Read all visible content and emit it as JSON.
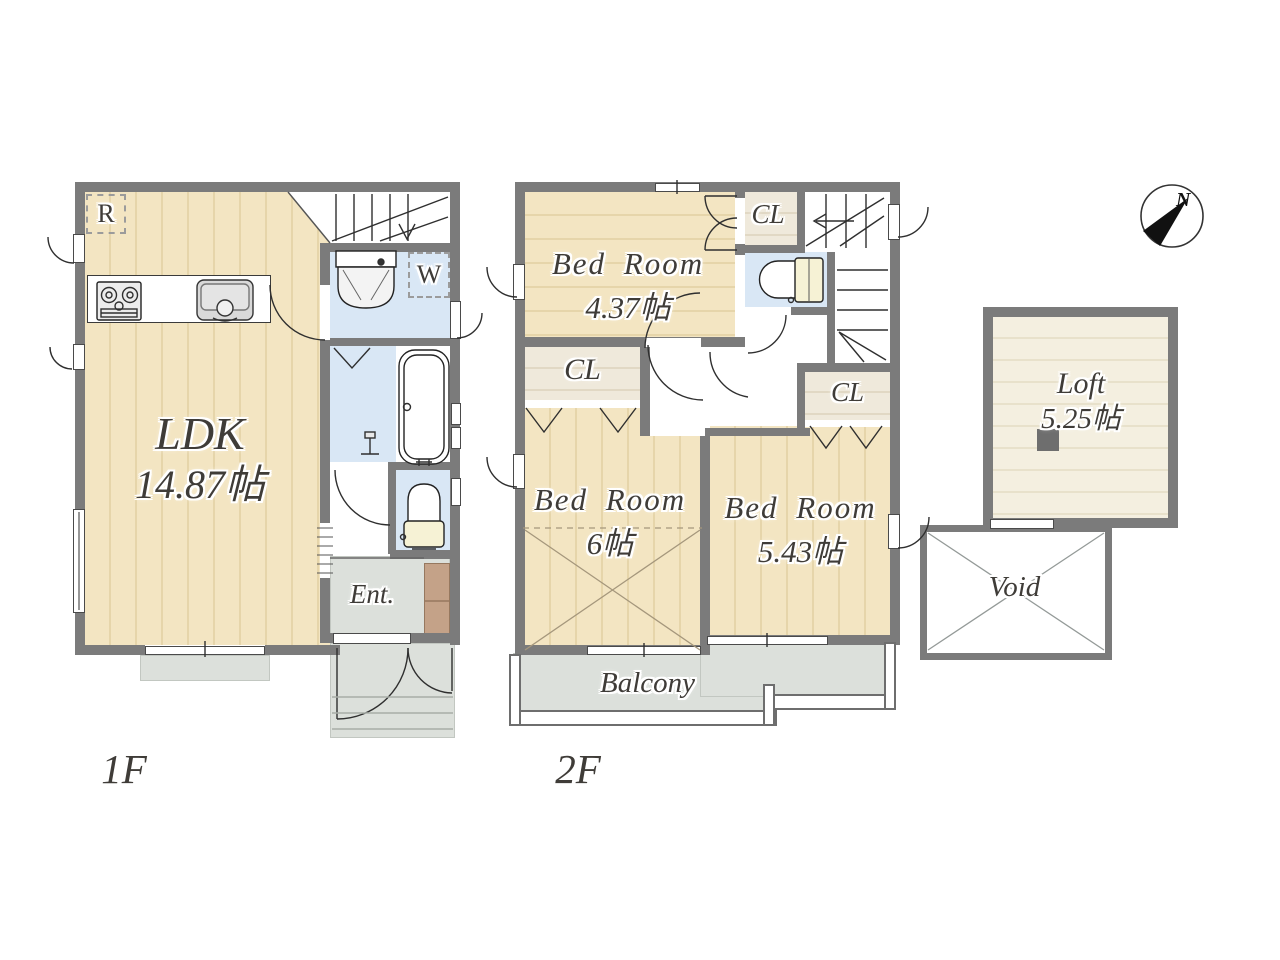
{
  "colors": {
    "wall": "#7b7b7b",
    "wet": "#d9e7f5",
    "tile": "#dce0db",
    "wood": "#f3e5c2",
    "ink": "#3f3c38"
  },
  "compass": {
    "north": "N"
  },
  "floor1": {
    "label": "1F",
    "ldk_name": "LDK",
    "ldk_area": "14.87帖",
    "entrance": "Ent.",
    "refrigerator": "R",
    "washer": "W"
  },
  "floor2": {
    "label": "2F",
    "bedroom_a_name": "Bed Room",
    "bedroom_a_area": "4.37帖",
    "bedroom_b_name": "Bed Room",
    "bedroom_b_area": "6帖",
    "bedroom_c_name": "Bed Room",
    "bedroom_c_area": "5.43帖",
    "closet_a": "CL",
    "closet_b": "CL",
    "closet_c": "CL",
    "balcony": "Balcony"
  },
  "loft": {
    "name": "Loft",
    "area": "5.25帖"
  },
  "void": {
    "label": "Void"
  }
}
